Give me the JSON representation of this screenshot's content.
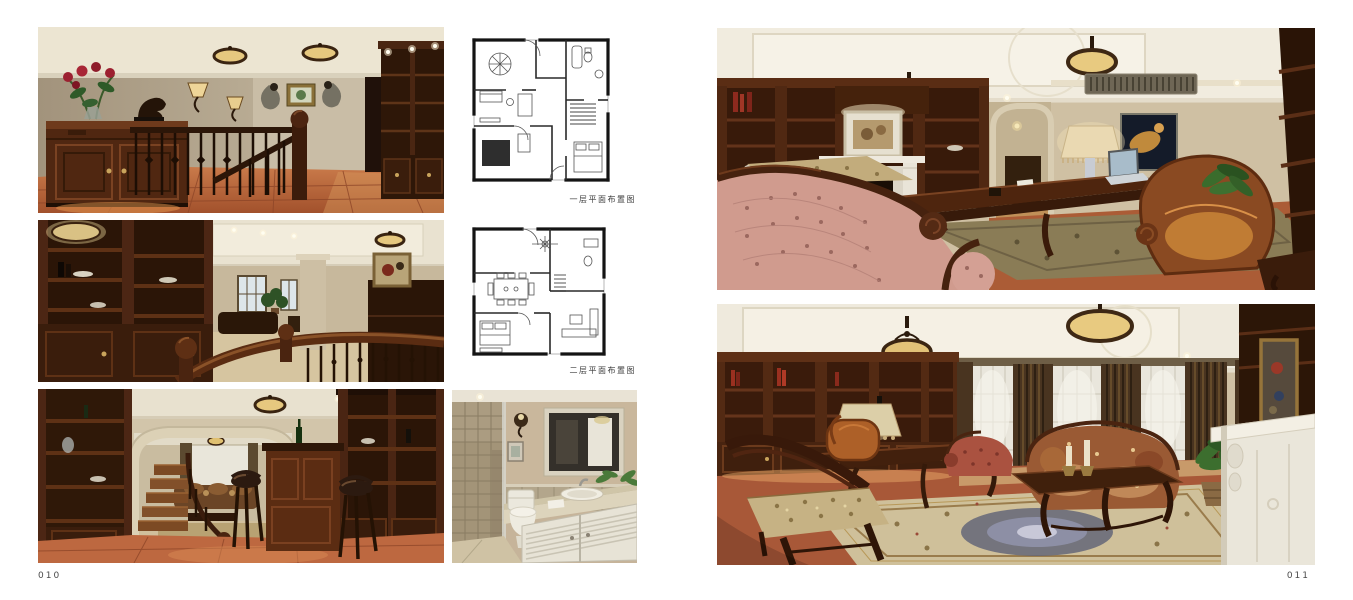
{
  "spread": {
    "left_page": {
      "number": "010"
    },
    "right_page": {
      "number": "011"
    }
  },
  "captions": {
    "floorplan_level1": "一层平面布置图",
    "floorplan_level2": "二层平面布置图"
  },
  "photos": {
    "hallway_landing": "Stair landing with wood sideboard, red roses, wall sconces, iron railing, built-in bookcase and terracotta tile floor",
    "bookcase_stair_hall": "Dark wood built-in bookcase beside stair with wood handrail overlooking living area",
    "bar_lounge": "Home bar with leather stools, wine cabinet, staircase and arched opening to living room",
    "bathroom": "Bathroom with stone-tiled shower, toilet, louvered vanity and framed mirror",
    "study_room": "Study with built-in bookcases, white fireplace mantel, pink tufted chaise, writing desk with laptop and leather armchair",
    "living_room": "Living room with bookcase wall, curtained windows, floral sofa, carved tables, ornate rug and white fireplace"
  },
  "palette": {
    "page_background": "#ffffff",
    "dark_wood": "#2e1708",
    "mid_wood": "#5b2c12",
    "terracotta_floor": "#b4613c",
    "wall_taupe": "#b9ac94",
    "ceiling_cream": "#ece5d4",
    "lamp_glow": "#e6c87f",
    "caption_text": "#3c3c3c"
  }
}
